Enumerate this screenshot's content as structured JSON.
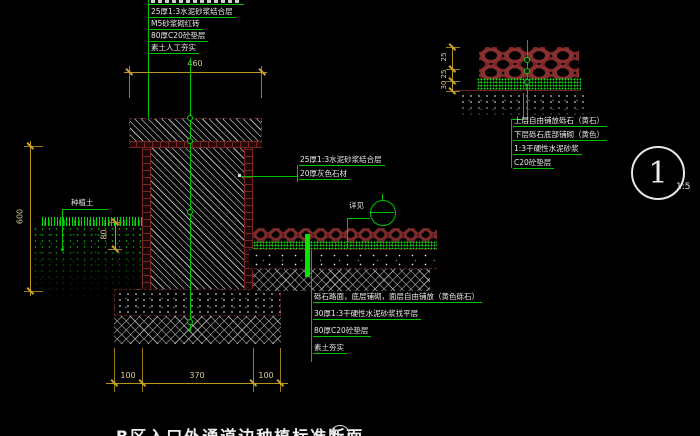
{
  "drawing": {
    "title": "B区入口外通道边种植标准断面",
    "scale": "1:5",
    "detail_number": "1"
  },
  "labels": {
    "planting_soil": "种植土",
    "see_detail": "详见"
  },
  "annotations": {
    "top_left": [
      "25厚1:3水泥砂浆结合层",
      "M5砂浆砌红砖",
      "80厚C20砼垫层",
      "素土人工夯实"
    ],
    "pavement_right": [
      "25厚1:3水泥砂浆结合层",
      "20厚灰色石材"
    ],
    "bottom": [
      "砾石路面，底层铺砌，面层自由铺放（黄色砾石）",
      "30厚1:3干硬性水泥砂浆找平层",
      "80厚C20砼垫层",
      "素土夯实"
    ],
    "gravel_detail": [
      "上层自由铺放砾石（黄石）",
      "下层砾石底部铺砌（黄色）",
      "1:3干硬性水泥砂浆",
      "C20砼垫层"
    ]
  },
  "dimensions": {
    "wall_top_width": "460",
    "wall_height": "600",
    "soil_depth": "80",
    "footing_segments": [
      "100",
      "370",
      "100"
    ],
    "gravel_layers": [
      "25",
      "25",
      "30"
    ]
  },
  "colors": {
    "leader_green": "#00c300",
    "dimension_yellow": "#b8951e",
    "brick_red": "#7a2424",
    "annotation_white": "#e9e9e9",
    "background": "#000000"
  }
}
